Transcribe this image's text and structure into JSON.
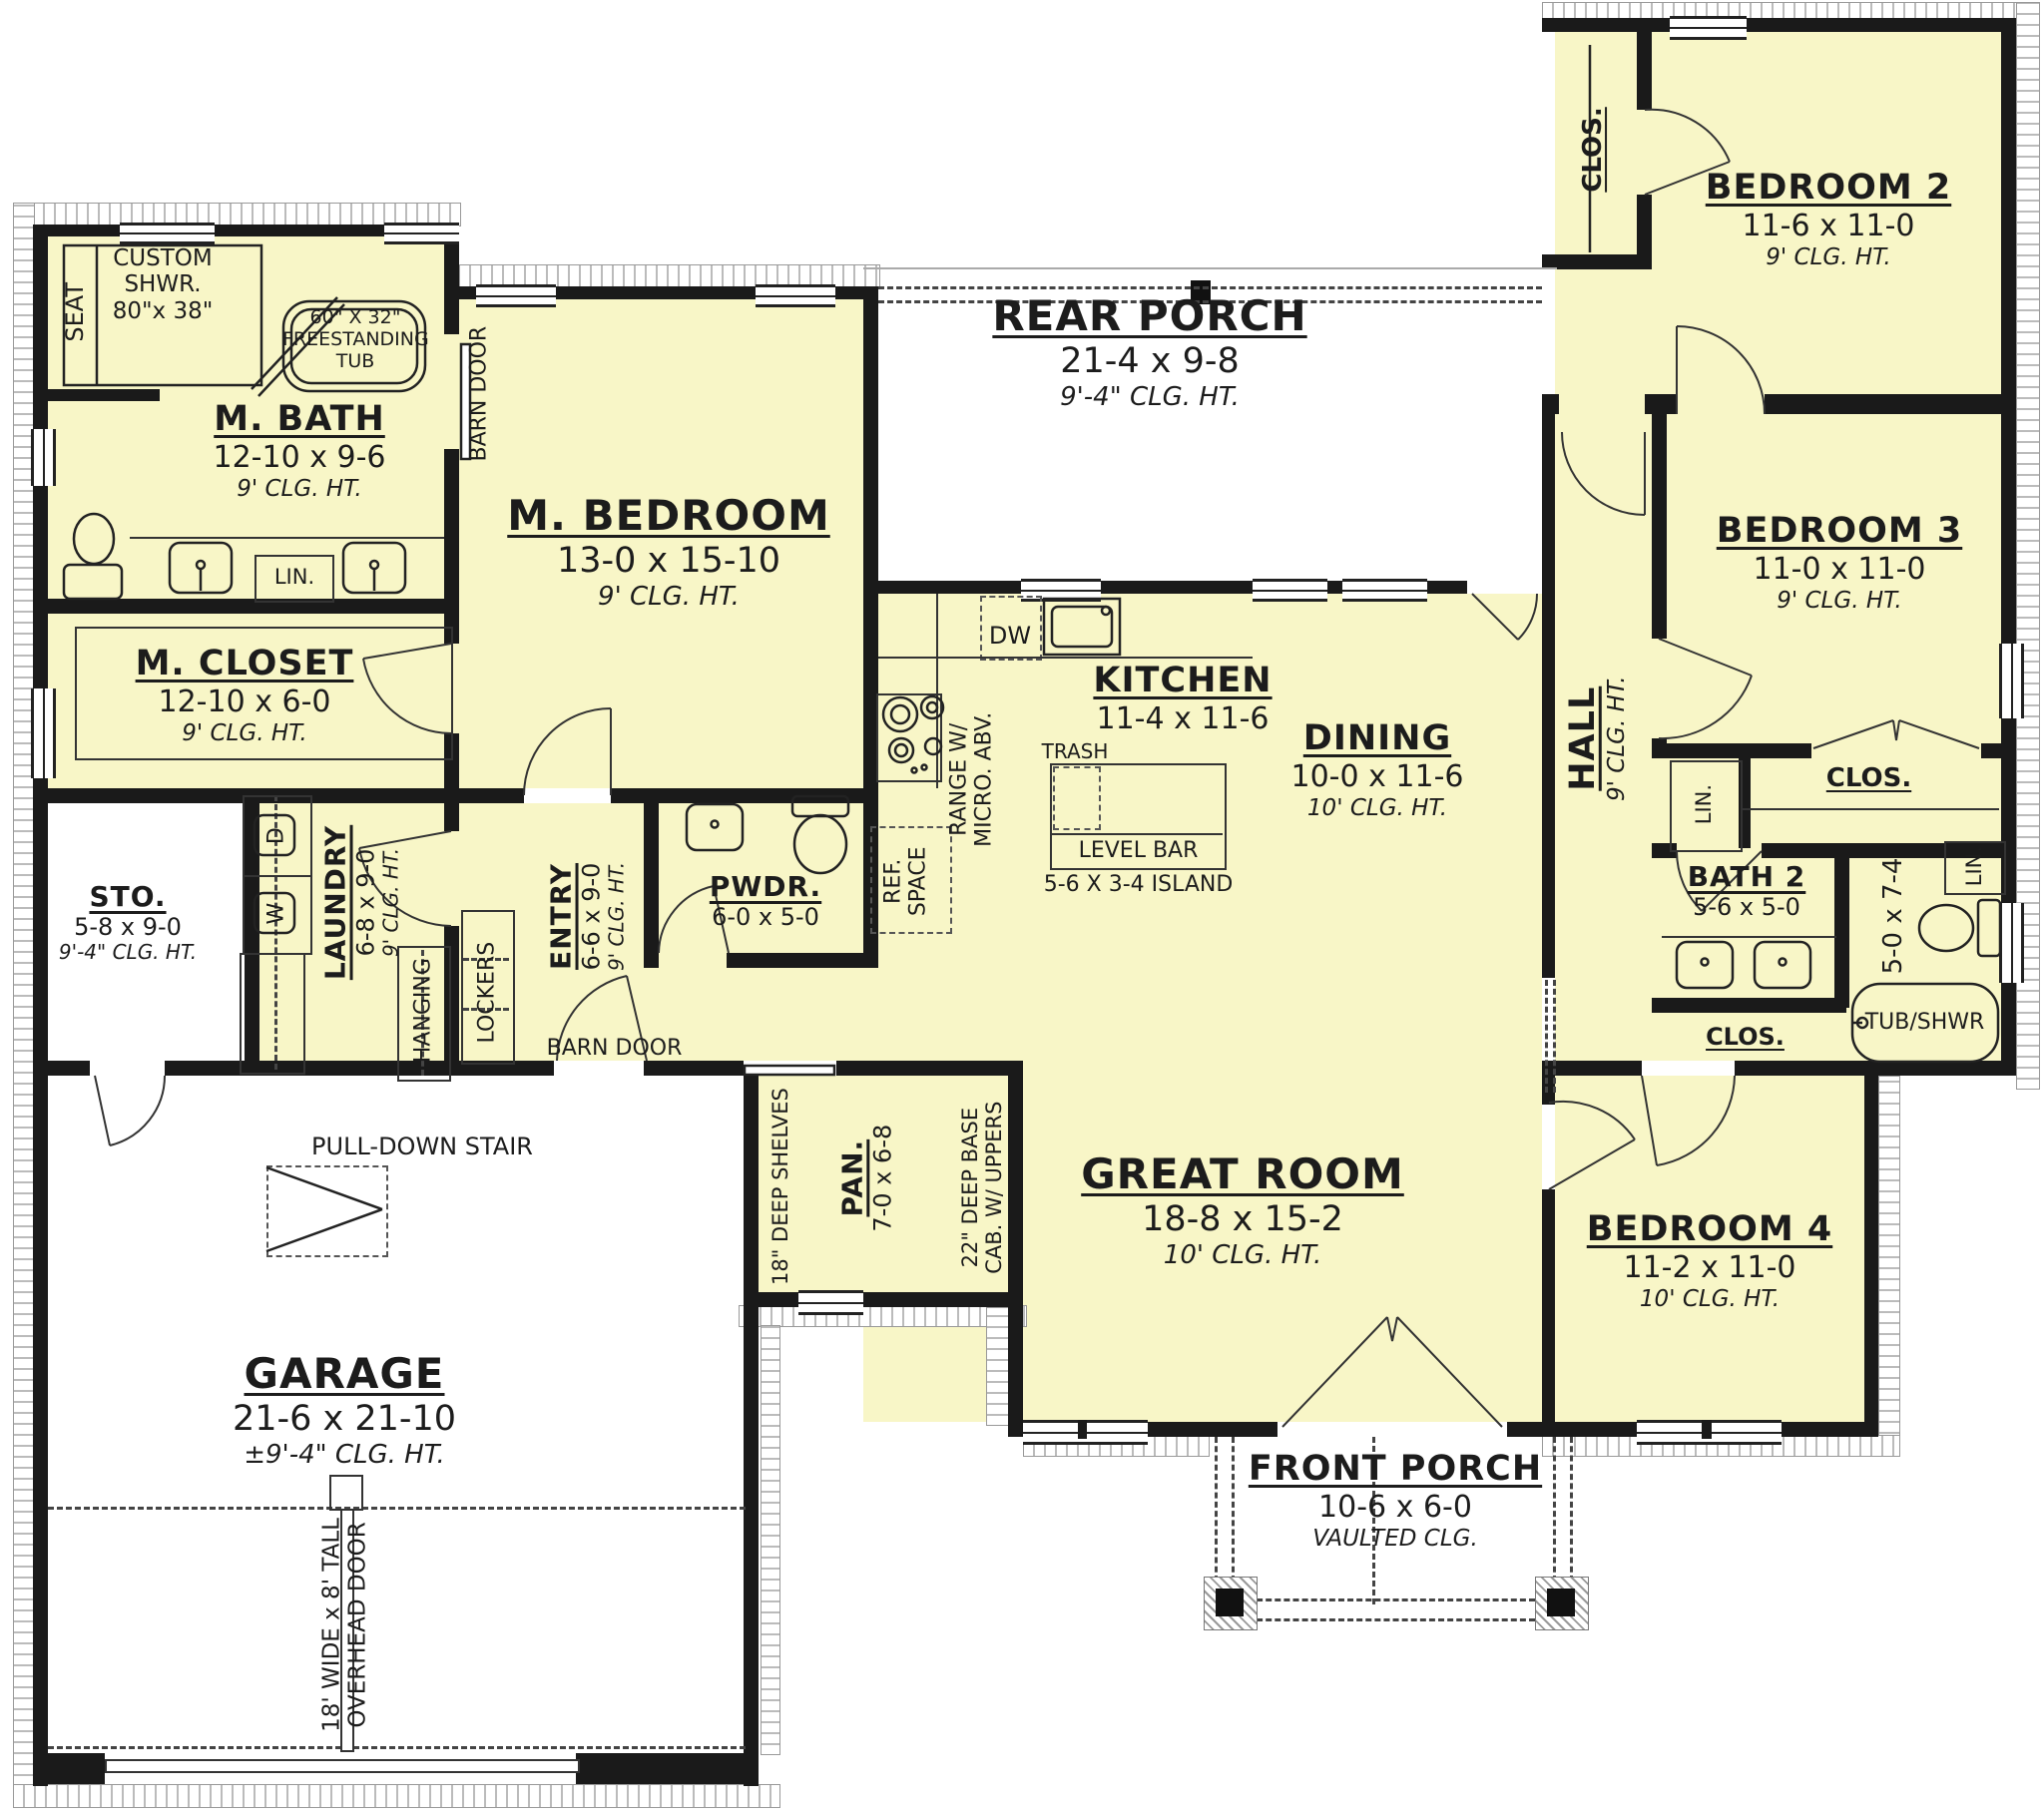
{
  "rooms": {
    "m_bath": {
      "name": "M. BATH",
      "dim": "12-10 x 9-6",
      "clg": "9' CLG. HT."
    },
    "m_closet": {
      "name": "M. CLOSET",
      "dim": "12-10 x 6-0",
      "clg": "9' CLG. HT."
    },
    "m_bedroom": {
      "name": "M. BEDROOM",
      "dim": "13-0 x 15-10",
      "clg": "9' CLG. HT."
    },
    "sto": {
      "name": "STO.",
      "dim": "5-8 x 9-0",
      "clg": "9'-4\" CLG. HT."
    },
    "laundry": {
      "name": "LAUNDRY",
      "dim": "6-8 x 9-0",
      "clg": "9' CLG. HT."
    },
    "entry": {
      "name": "ENTRY",
      "dim": "6-6 x 9-0",
      "clg": "9' CLG. HT."
    },
    "pwdr": {
      "name": "PWDR.",
      "dim": "6-0 x 5-0"
    },
    "pan": {
      "name": "PAN.",
      "dim": "7-0 x 6-8"
    },
    "kitchen": {
      "name": "KITCHEN",
      "dim": "11-4 x 11-6"
    },
    "dining": {
      "name": "DINING",
      "dim": "10-0 x 11-6",
      "clg": "10' CLG. HT."
    },
    "great_room": {
      "name": "GREAT ROOM",
      "dim": "18-8 x 15-2",
      "clg": "10' CLG. HT."
    },
    "rear_porch": {
      "name": "REAR PORCH",
      "dim": "21-4 x 9-8",
      "clg": "9'-4\" CLG. HT."
    },
    "front_porch": {
      "name": "FRONT PORCH",
      "dim": "10-6 x 6-0",
      "clg": "VAULTED CLG."
    },
    "garage": {
      "name": "GARAGE",
      "dim": "21-6 x 21-10",
      "clg": "±9'-4\" CLG. HT."
    },
    "bedroom2": {
      "name": "BEDROOM 2",
      "dim": "11-6 x 11-0",
      "clg": "9' CLG. HT."
    },
    "bedroom3": {
      "name": "BEDROOM 3",
      "dim": "11-0 x 11-0",
      "clg": "9' CLG. HT."
    },
    "bedroom4": {
      "name": "BEDROOM 4",
      "dim": "11-2 x 11-0",
      "clg": "10' CLG. HT."
    },
    "bath2": {
      "name": "BATH 2",
      "dim": "5-6 x 5-0"
    },
    "bath2_wet": {
      "dim": "5-0 x 7-4"
    },
    "hall": {
      "name": "HALL",
      "clg": "9' CLG. HT."
    }
  },
  "annotations": {
    "seat": "SEAT",
    "custom_shwr_l1": "CUSTOM",
    "custom_shwr_l2": "SHWR.",
    "custom_shwr_l3": "80\"x 38\"",
    "tub_l1": "60\" X 32\"",
    "tub_l2": "FREESTANDING",
    "tub_l3": "TUB",
    "barn_door": "BARN DOOR",
    "lin": "LIN.",
    "hanging": "HANGING",
    "lockers": "LOCKERS",
    "pull_down_stair": "PULL-DOWN STAIR",
    "overhead_l1": "18' WIDE x 8' TALL",
    "overhead_l2": "OVERHEAD DOOR",
    "shelves": "18\" DEEP SHELVES",
    "base_l1": "22\" DEEP BASE",
    "base_l2": "CAB. W/ UPPERS",
    "dw": "DW",
    "trash": "TRASH",
    "level_bar": "LEVEL BAR",
    "island": "5-6 X 3-4 ISLAND",
    "range_l1": "RANGE W/",
    "range_l2": "MICRO. ABV.",
    "ref_l1": "REF.",
    "ref_l2": "SPACE",
    "tub_shwr": "TUB/SHWR",
    "clos": "CLOS.",
    "washer": "W",
    "dryer": "D"
  }
}
